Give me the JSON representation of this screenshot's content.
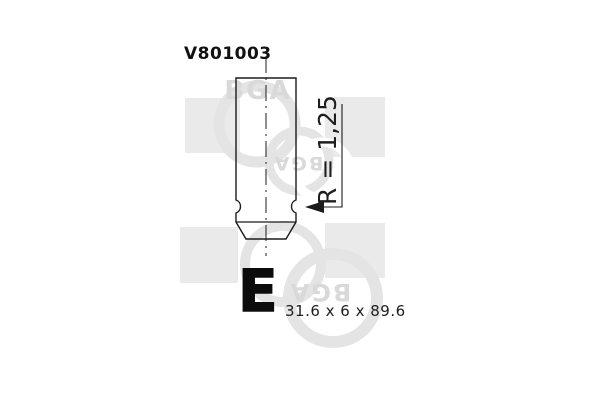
{
  "title": {
    "part_number": "V801003"
  },
  "drawing": {
    "type": "engine-valve-technical-drawing",
    "radius_label": "R = 1,25",
    "valve_code_letter": "E",
    "dimensions_label": "31.6 x 6 x 89.6"
  },
  "watermark": {
    "brand": "BGA"
  },
  "colors": {
    "background": "#ffffff",
    "drawing_line": "#1b1b1b",
    "text": "#111111",
    "watermark_square": "#eaeaea",
    "watermark_ring": "#e4e4e4",
    "watermark_text": "#d9d9d9"
  }
}
